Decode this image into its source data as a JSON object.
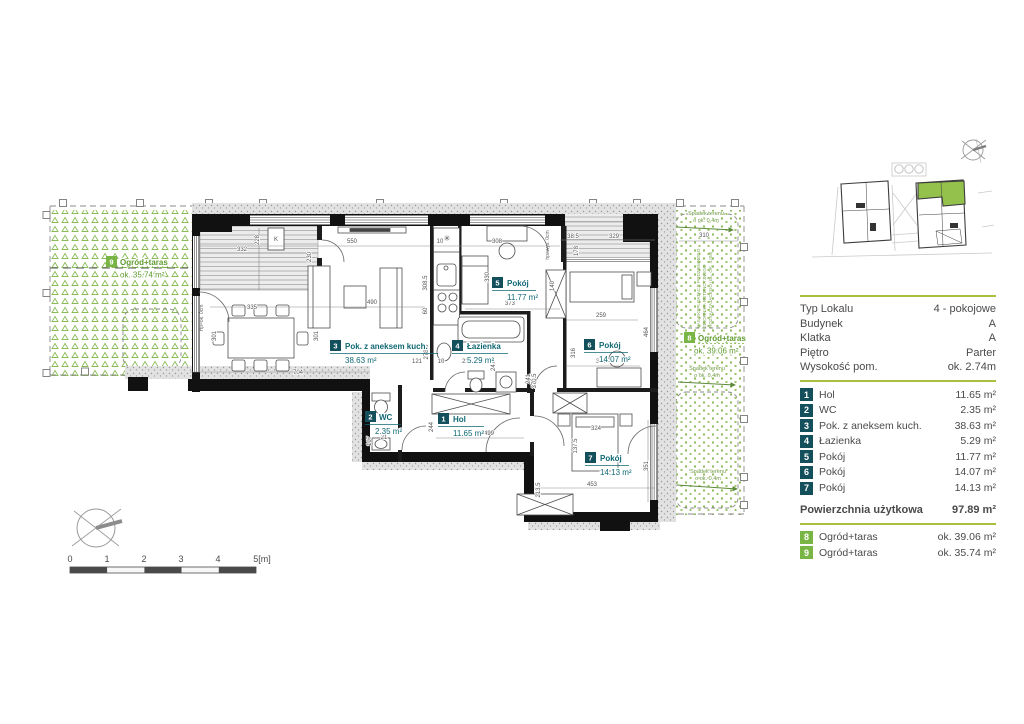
{
  "panel": {
    "info": [
      {
        "label": "Typ Lokalu",
        "value": "4 - pokojowe"
      },
      {
        "label": "Budynek",
        "value": "A"
      },
      {
        "label": "Klatka",
        "value": "A"
      },
      {
        "label": "Piętro",
        "value": "Parter"
      },
      {
        "label": "Wysokość pom.",
        "value": "ok. 2.74m"
      }
    ],
    "total": {
      "label": "Powierzchnia użytkowa",
      "value": "97.89 m²"
    }
  },
  "rooms": [
    {
      "num": "1",
      "name": "Hol",
      "area": "11.65 m²"
    },
    {
      "num": "2",
      "name": "WC",
      "area": "2.35 m²"
    },
    {
      "num": "3",
      "name": "Pok. z aneksem kuch.",
      "area": "38.63 m²"
    },
    {
      "num": "4",
      "name": "Łazienka",
      "area": "5.29 m²"
    },
    {
      "num": "5",
      "name": "Pokój",
      "area": "11.77 m²"
    },
    {
      "num": "6",
      "name": "Pokój",
      "area": "14.07 m²"
    },
    {
      "num": "7",
      "name": "Pokój",
      "area": "14.13 m²"
    }
  ],
  "outdoor": [
    {
      "num": "8",
      "name": "Ogród+taras",
      "area": "ok. 39.06 m²"
    },
    {
      "num": "9",
      "name": "Ogród+taras",
      "area": "ok. 35.74 m²"
    }
  ],
  "plan": {
    "dims": [
      "550",
      "10",
      "308",
      "38.5",
      "329",
      "332",
      "228",
      "178",
      "230",
      "308.5",
      "60",
      "330",
      "373",
      "335",
      "301",
      "490",
      "301",
      "704",
      "121",
      "10",
      "237",
      "247",
      "241",
      "278.5",
      "499",
      "244",
      "370.5",
      "324",
      "137.5",
      "213.5",
      "453",
      "351",
      "259",
      "316",
      "324",
      "464",
      "310",
      "107",
      "21",
      "140"
    ],
    "annotations": {
      "slope1": "Spadek terenu",
      "slope2": "o ok. 0,4m",
      "tank1": "PAS EKSPLOATACJI PODZIEMNEGO",
      "tank2": "ZBIORNIKA RETENCYJNEGO",
      "tank3": "ROZSĄCZAJĄCEGO (GŁ. OK. 4,0M)",
      "hp1": "Hp=ok. 0cm",
      "hp2": "hp=wys. 0cm",
      "k": "K"
    },
    "icons": {
      "fridge": "✳"
    },
    "scale_ticks": [
      "0",
      "1",
      "2",
      "3",
      "4",
      "5[m]"
    ]
  },
  "colors": {
    "badge_teal": "#14505c",
    "badge_green": "#79b544",
    "separator_green": "#a9bf3d",
    "garden_green": "#8bbb57",
    "label_teal": "#0f6874"
  }
}
